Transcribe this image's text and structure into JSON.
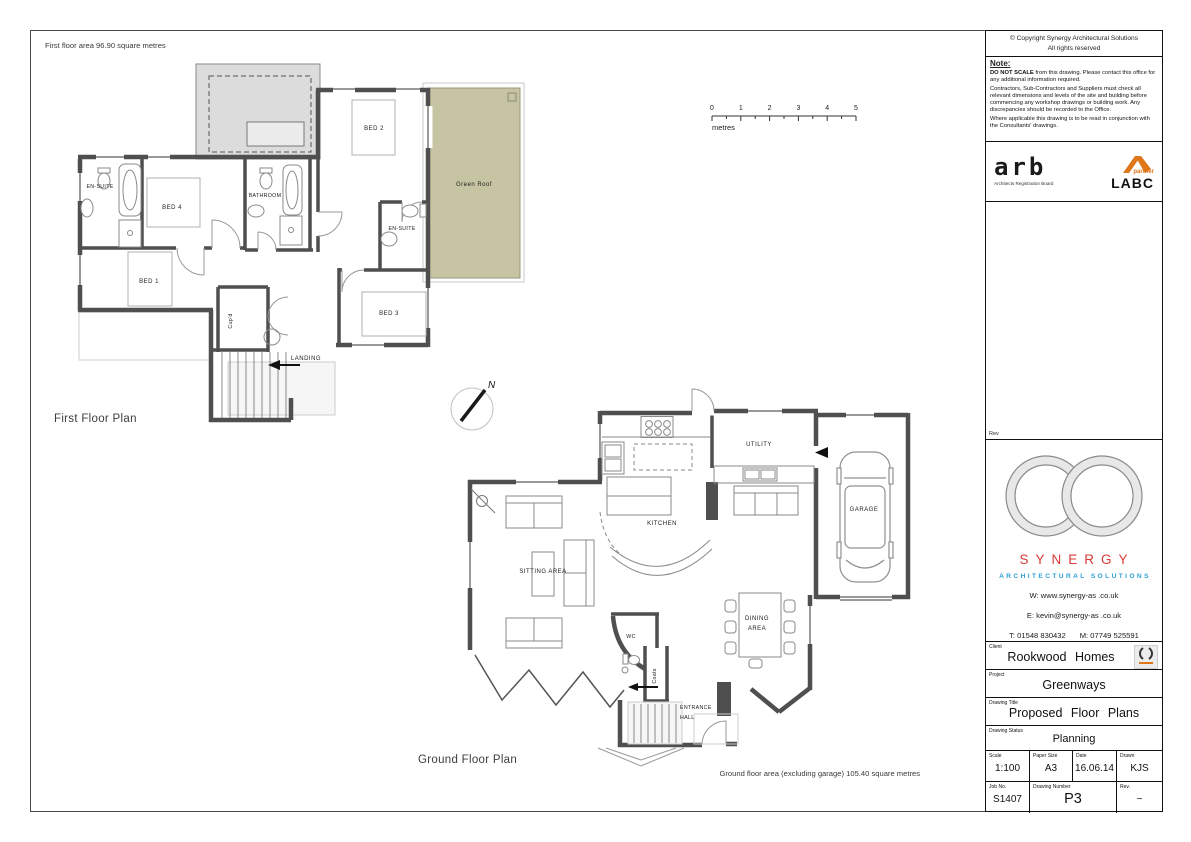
{
  "drawing": {
    "first_floor": {
      "area_note": "First floor area 96.90 square metres",
      "plan_label": "First Floor Plan",
      "rooms": {
        "ensuite_a": "EN-SUITE",
        "bed4": "BED 4",
        "bathroom": "BATHROOM",
        "bed2": "BED 2",
        "ensuite_b": "EN-SUITE",
        "bed1": "BED 1",
        "cupd": "Cup'd",
        "landing": "LANDING",
        "bed3": "BED 3",
        "green_roof": "Green Roof"
      }
    },
    "ground_floor": {
      "plan_label": "Ground Floor Plan",
      "area_note": "Ground floor area (excluding garage) 105.40 square metres",
      "rooms": {
        "kitchen": "KITCHEN",
        "utility": "UTILITY",
        "garage": "GARAGE",
        "sitting_area": "SITTING AREA",
        "dining_line1": "DINING",
        "dining_line2": "AREA",
        "wc": "WC",
        "coats": "Coats",
        "entrance_line1": "ENTRANCE",
        "entrance_line2": "HALL"
      }
    },
    "scale_bar": {
      "ticks": [
        "0",
        "1",
        "2",
        "3",
        "4",
        "5"
      ],
      "unit": "metres"
    },
    "north_label": "N"
  },
  "title_block": {
    "copyright_line1": "© Copyright Synergy Architectural Solutions",
    "copyright_line2": "All rights reserved",
    "note": {
      "heading": "Note:",
      "p1_bold": "DO NOT SCALE",
      "p1_rest": " from this drawing. Please contact this office for any additional information required.",
      "p2": "Contractors, Sub-Contractors and Suppliers must check all relevant dimensions and levels of the site and building before commencing any workshop drawings or building work. Any discrepancies should be recorded to the Office.",
      "p3": "Where applicable this drawing is to be read in conjunction with the Consultants' drawings."
    },
    "arb": {
      "name": "arb",
      "caption": "Architects Registration Board"
    },
    "labc": {
      "partner": "partner",
      "name": "LABC"
    },
    "rev_space_label": "Rev",
    "brand": {
      "name": "SYNERGY",
      "tagline": "ARCHITECTURAL SOLUTIONS",
      "web": "W: www.synergy-as .co.uk",
      "email": "E: kevin@synergy-as .co.uk",
      "phone_t": "T: 01548 830432",
      "phone_m": "M: 07749 525591"
    },
    "client": {
      "label": "Client",
      "value": "Rookwood Homes"
    },
    "project": {
      "label": "Project",
      "value": "Greenways"
    },
    "drawing_title": {
      "label": "Drawing Title",
      "value": "Proposed Floor Plans"
    },
    "drawing_status": {
      "label": "Drawing Status",
      "value": "Planning"
    },
    "scale": {
      "label": "Scale",
      "value": "1:100"
    },
    "paper_size": {
      "label": "Paper Size",
      "value": "A3"
    },
    "date": {
      "label": "Date",
      "value": "16.06.14"
    },
    "drawn": {
      "label": "Drawn",
      "value": "KJS"
    },
    "job_no": {
      "label": "Job No.",
      "value": "S1407"
    },
    "drawing_number": {
      "label": "Drawing Number",
      "value": "P3"
    },
    "revision": {
      "label": "Rev.",
      "value": "~"
    }
  },
  "colors": {
    "wall": "#4f4f4f",
    "green_roof": "#c6c4a2",
    "flat_roof": "#dcdcdc",
    "brand_red": "#d93a36",
    "brand_blue": "#2f9fd6",
    "labc_orange": "#e0761a"
  }
}
